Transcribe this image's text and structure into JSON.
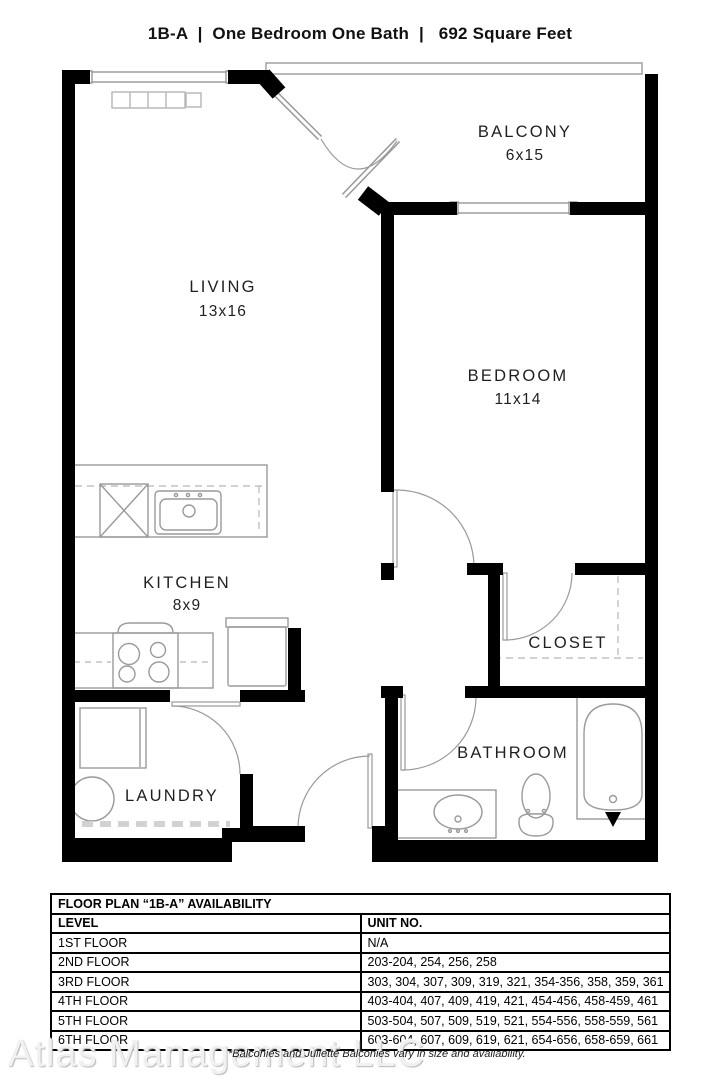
{
  "title": {
    "plan_code": "1B-A",
    "separator": "|",
    "description": "One Bedroom One Bath",
    "square_feet": "692 Square Feet"
  },
  "rooms": {
    "living": {
      "label": "LIVING",
      "dims": "13x16"
    },
    "bedroom": {
      "label": "BEDROOM",
      "dims": "11x14"
    },
    "kitchen": {
      "label": "KITCHEN",
      "dims": "8x9"
    },
    "balcony": {
      "label": "BALCONY",
      "dims": "6x15"
    },
    "laundry": {
      "label": "LAUNDRY"
    },
    "bathroom": {
      "label": "BATHROOM"
    },
    "closet": {
      "label": "CLOSET"
    }
  },
  "fixtures": [
    "kitchen-sink",
    "dishwasher",
    "stove",
    "refrigerator",
    "washer",
    "water-heater",
    "bathroom-vanity-sink",
    "toilet",
    "bathtub"
  ],
  "availability": {
    "table_title": "FLOOR PLAN “1B-A” AVAILABILITY",
    "columns": {
      "level": "LEVEL",
      "units": "UNIT NO."
    },
    "rows": [
      {
        "level": "1ST FLOOR",
        "units": "N/A"
      },
      {
        "level": "2ND FLOOR",
        "units": "203-204, 254, 256, 258"
      },
      {
        "level": "3RD FLOOR",
        "units": "303, 304, 307, 309, 319, 321, 354-356, 358, 359, 361"
      },
      {
        "level": "4TH FLOOR",
        "units": "403-404, 407, 409, 419, 421, 454-456, 458-459, 461"
      },
      {
        "level": "5TH FLOOR",
        "units": "503-504, 507, 509, 519, 521, 554-556, 558-559, 561"
      },
      {
        "level": "6TH FLOOR",
        "units": "603-604, 607, 609, 619, 621, 654-656, 658-659, 661"
      }
    ]
  },
  "footer": {
    "watermark": "Atlas Management LLC",
    "note": "*Balconies and Juliette Balconies vary in size and availability."
  },
  "colors": {
    "wall": "#000000",
    "fixture_line": "#9a9a9a",
    "text": "#1f1f1f",
    "watermark": "#f1f1f1"
  }
}
